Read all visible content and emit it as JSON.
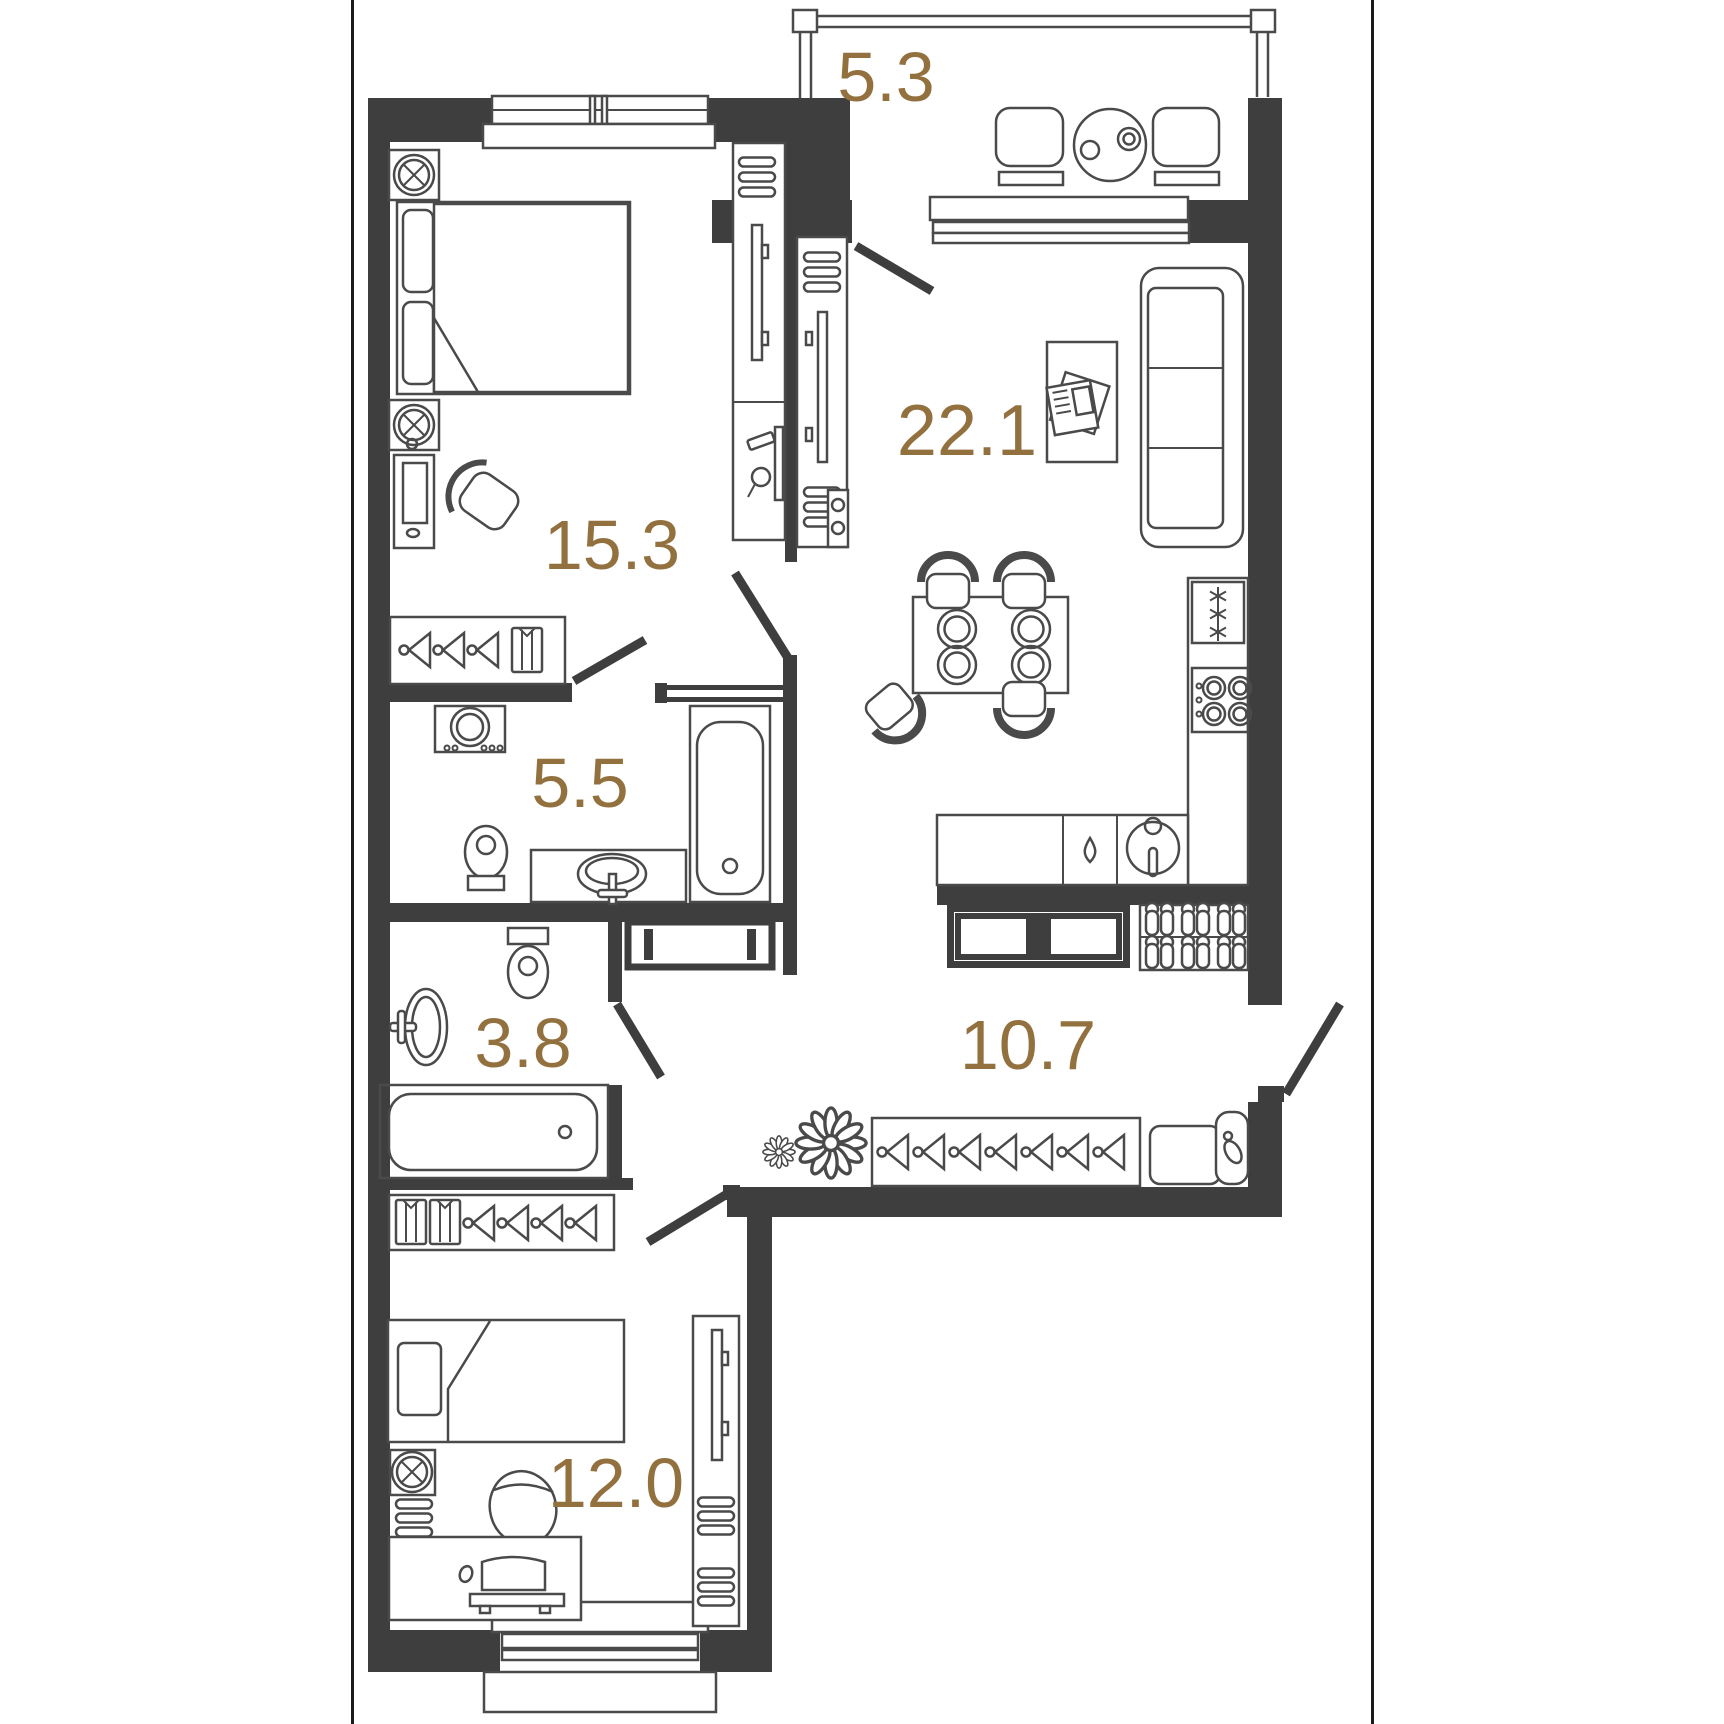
{
  "plan": {
    "type": "apartment-floor-plan",
    "colors": {
      "accent": "#92713f",
      "wall": "#3e3e3e",
      "furniture_line": "#4a4a4a",
      "background": "#ffffff"
    },
    "rooms": [
      {
        "id": "balcony",
        "area": "5.3"
      },
      {
        "id": "living-kitchen",
        "area": "22.1"
      },
      {
        "id": "bedroom",
        "area": "15.3"
      },
      {
        "id": "bathroom",
        "area": "5.5"
      },
      {
        "id": "bathroom-2",
        "area": "3.8"
      },
      {
        "id": "hallway",
        "area": "10.7"
      },
      {
        "id": "bedroom-2",
        "area": "12.0"
      }
    ]
  }
}
